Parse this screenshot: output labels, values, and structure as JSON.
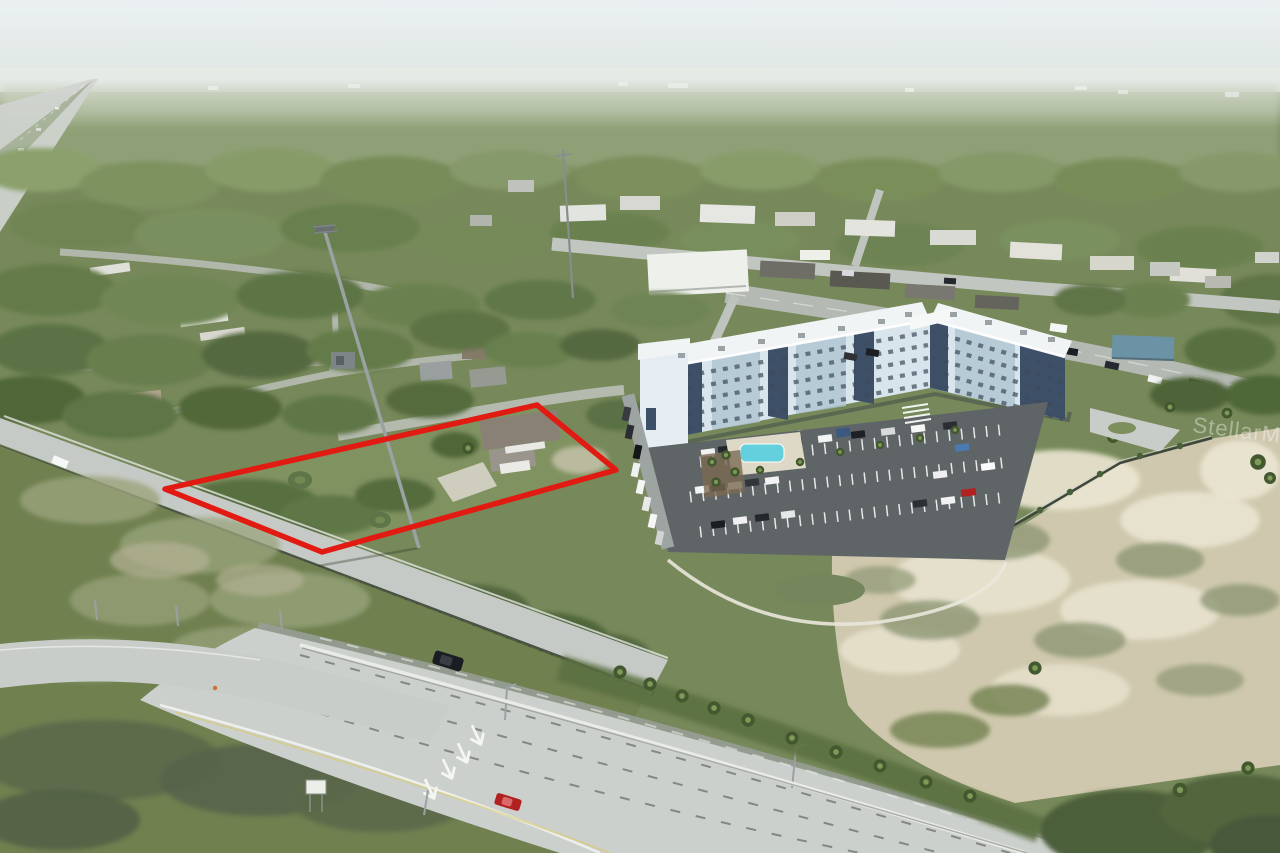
{
  "watermark": {
    "text": "StellarMLS"
  },
  "scene": {
    "type": "aerial-drone-photograph",
    "subject": "vacant-land-parcel-outlined-in-red-beside-apartment-complex-and-highway"
  },
  "colors": {
    "sky_top": "#e9eff1",
    "sky_haze": "#dfe7e2",
    "tree_dark": "#4e6339",
    "tree": "#667f4a",
    "tree_light": "#7e965d",
    "tree_haze": "#a9b695",
    "grass": "#70804f",
    "grass_light": "#9aa47c",
    "sand": "#cfc8ae",
    "sand_light": "#ebe6d2",
    "scrub": "#8d9774",
    "road_concrete": "#ccd0cd",
    "road_asphalt": "#9aa09e",
    "road_light": "#c3c7c3",
    "barrier": "#e9ebe7",
    "guardrail": "#4b5147",
    "parcel_outline": "#e11b12",
    "building_face": "#d9e5ec",
    "building_face2": "#aec4d2",
    "building_accent": "#3e5068",
    "building_roof": "#f0f4f5",
    "parking": "#5f6567",
    "stripe": "#ffffff",
    "pool": "#5ecfdf",
    "car_red": "#b32020",
    "car_black": "#1a1d21",
    "car_white": "#f2f4f4",
    "watermark": "#ffffff"
  }
}
